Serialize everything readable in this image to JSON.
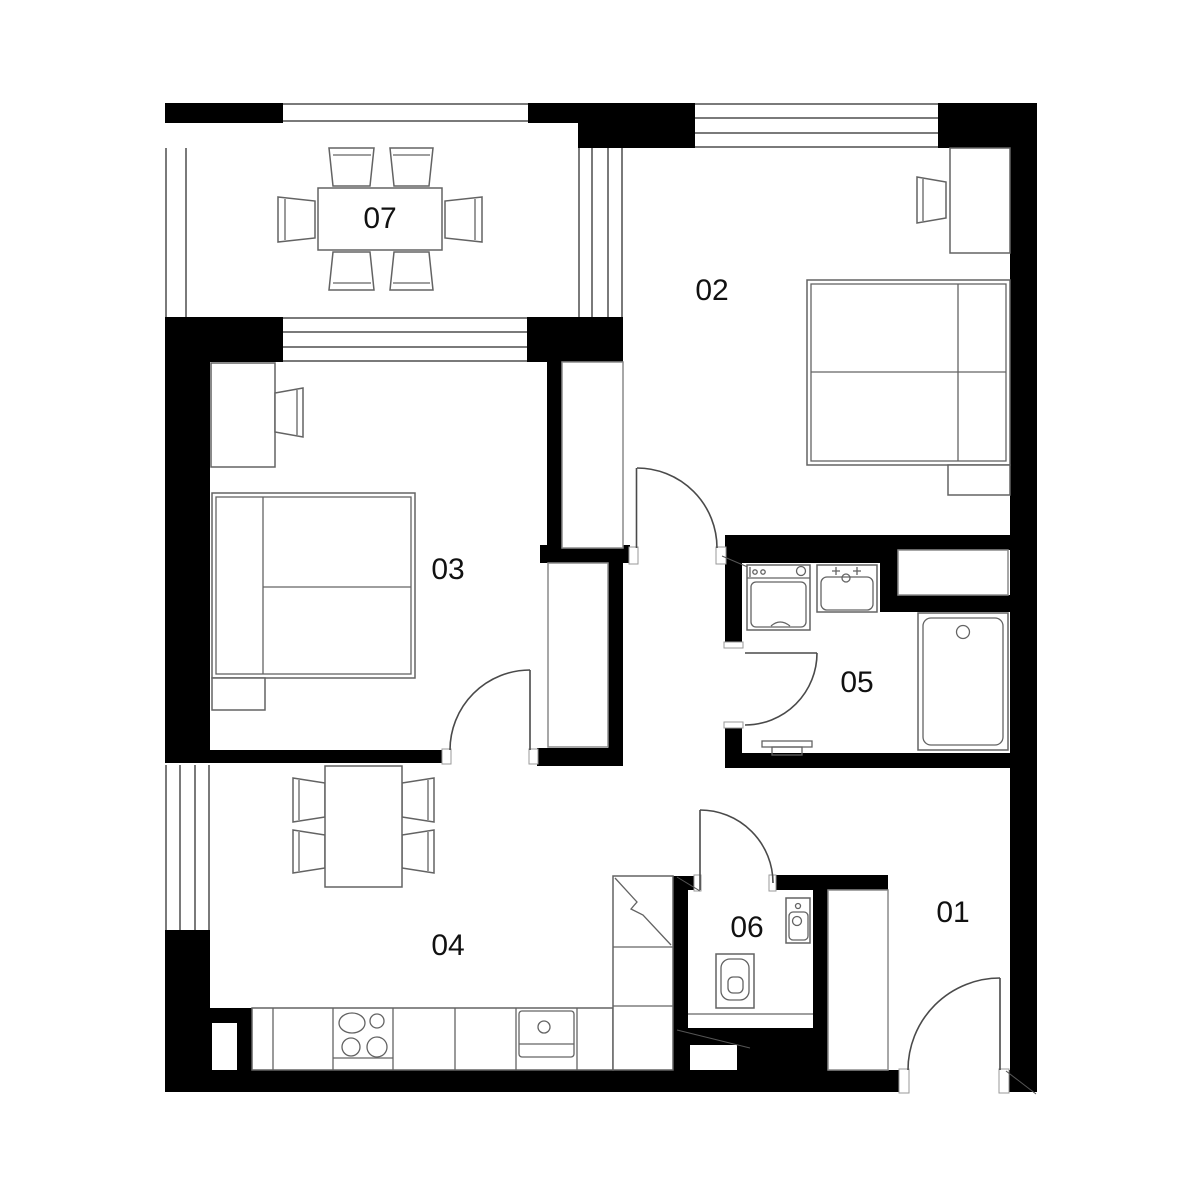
{
  "page": {
    "title": "Apartment floor plan"
  },
  "canvas": {
    "width": 1200,
    "height": 1200,
    "background_color": "#ffffff"
  },
  "colors": {
    "wall": "#000000",
    "window_line": "#7a7a7a",
    "door_line": "#4a4a4a",
    "furniture_line": "#636363",
    "label_text": "#111111"
  },
  "rooms": [
    {
      "label": "01"
    },
    {
      "label": "02"
    },
    {
      "label": "03"
    },
    {
      "label": "04"
    },
    {
      "label": "05"
    },
    {
      "label": "06"
    },
    {
      "label": "07"
    }
  ],
  "symbols": [
    "dining-table",
    "chair",
    "double-bed",
    "nightstand",
    "desk",
    "desk-chair",
    "wardrobe",
    "closet-niche",
    "kitchen-counter",
    "cooktop",
    "kitchen-sink",
    "washing-machine",
    "bathroom-sink",
    "shower-tray",
    "towel-radiator",
    "toilet",
    "washbasin",
    "door-swing",
    "window",
    "balcony-railing"
  ]
}
